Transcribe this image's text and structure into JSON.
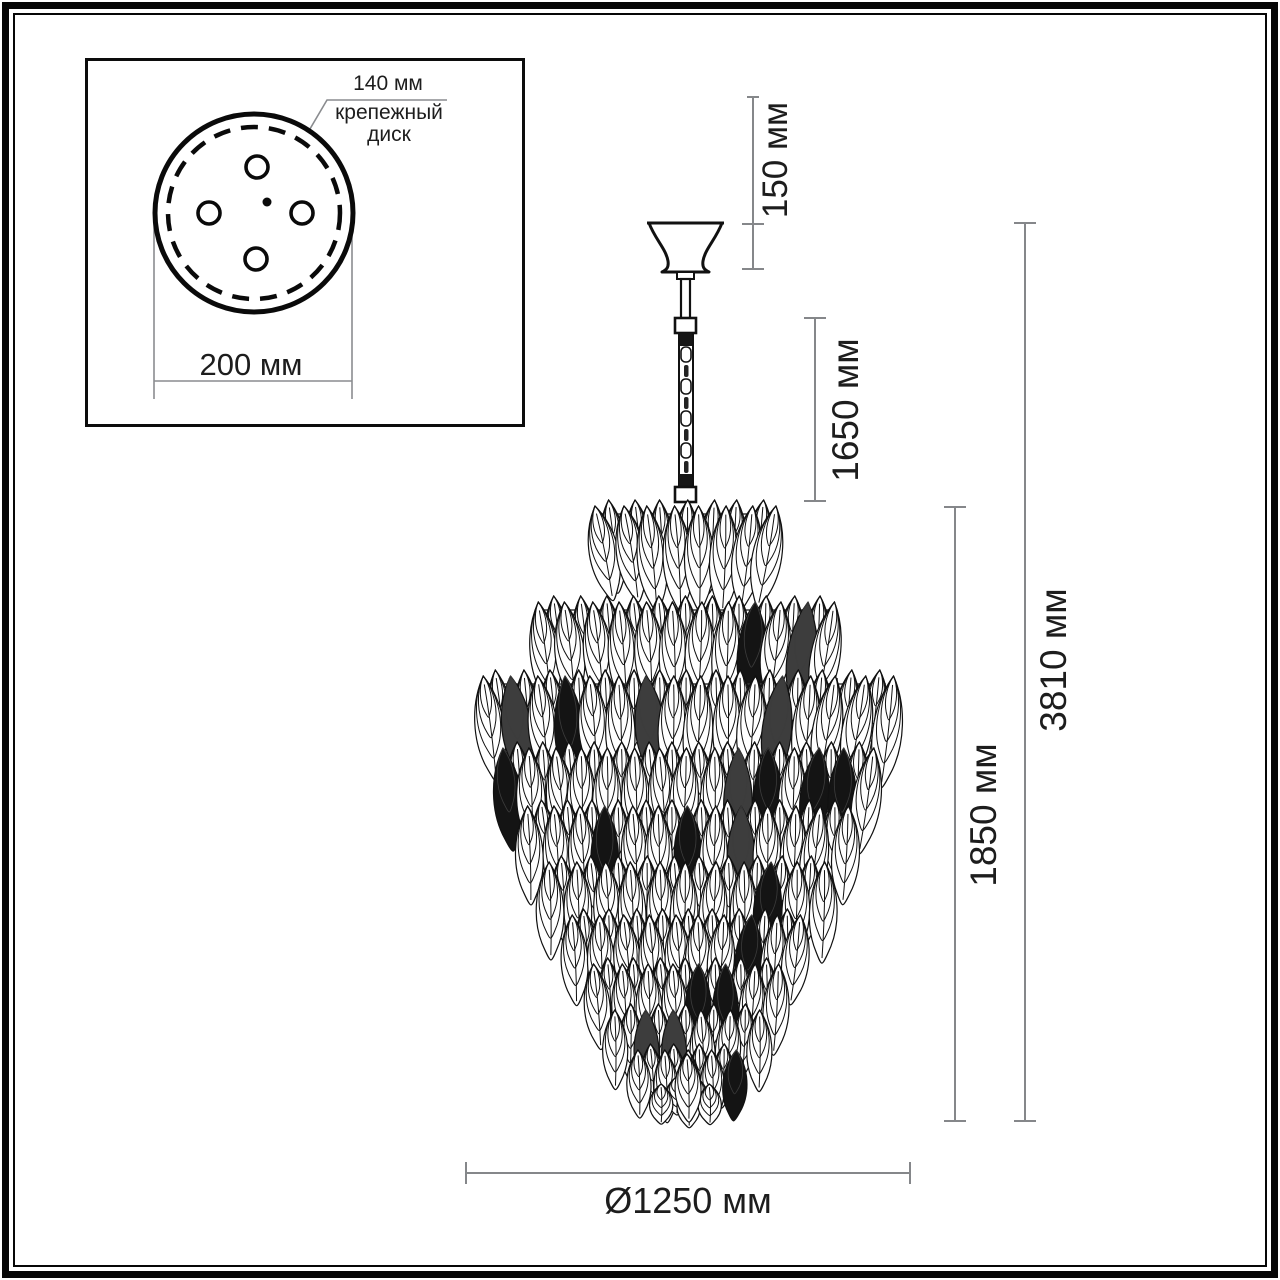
{
  "title": "Чертёж подвесной люстры с размерами",
  "inset": {
    "mount_diameter_label": "140 мм",
    "mount_part_label": "крепежный диск",
    "outer_diameter_label": "200 мм"
  },
  "dimensions": {
    "canopy_height": "150 мм",
    "chain_length": "1650 мм",
    "body_height": "1850 мм",
    "total_height": "3810 мм",
    "diameter": "Ø1250 мм"
  },
  "colors": {
    "dimension_line": "#85878a",
    "ink": "#111111",
    "text": "#1d1d1d",
    "background": "#ffffff"
  }
}
